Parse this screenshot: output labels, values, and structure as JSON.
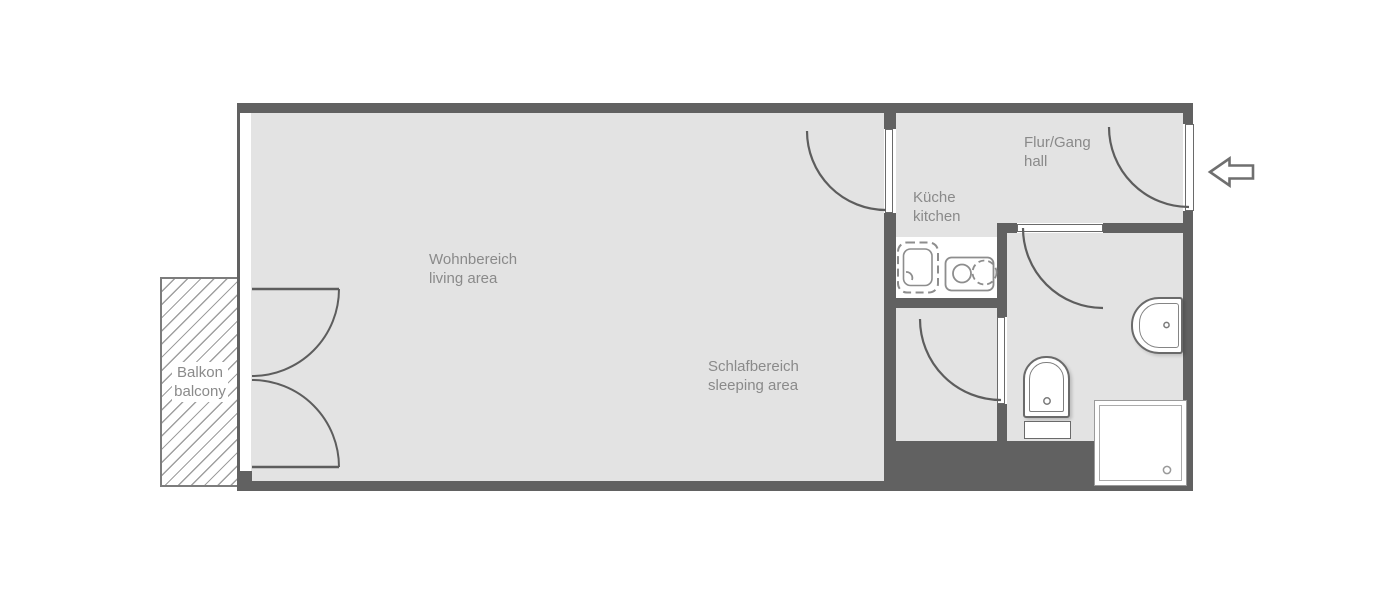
{
  "page": {
    "background": "#ffffff",
    "kind": "apartment floor plan"
  },
  "colors": {
    "wall": "#616161",
    "floor": "#e3e3e3",
    "label_text": "#8a8a8a",
    "fixture_outline": "#6a6a6a",
    "balcony_hatch": "#9f9f9f"
  },
  "labels": {
    "living": {
      "de": "Wohnbereich",
      "en": "living area"
    },
    "sleeping": {
      "de": "Schlafbereich",
      "en": "sleeping area"
    },
    "kitchen": {
      "de": "Küche",
      "en": "kitchen"
    },
    "hall": {
      "de": "Flur/Gang",
      "en": "hall"
    },
    "balcony": {
      "de": "Balkon",
      "en": "balcony"
    }
  },
  "fixtures": [
    "kitchen-sink",
    "cooktop-two-burner",
    "kitchen-counter",
    "toilet",
    "washbasin",
    "shower-tray"
  ],
  "symbols": {
    "entrance_arrow": "arrow-left",
    "doors": [
      "entrance-door",
      "living-room-door",
      "bathroom-door",
      "storage-door",
      "balcony-french-door"
    ],
    "window": "window-left-wall"
  }
}
